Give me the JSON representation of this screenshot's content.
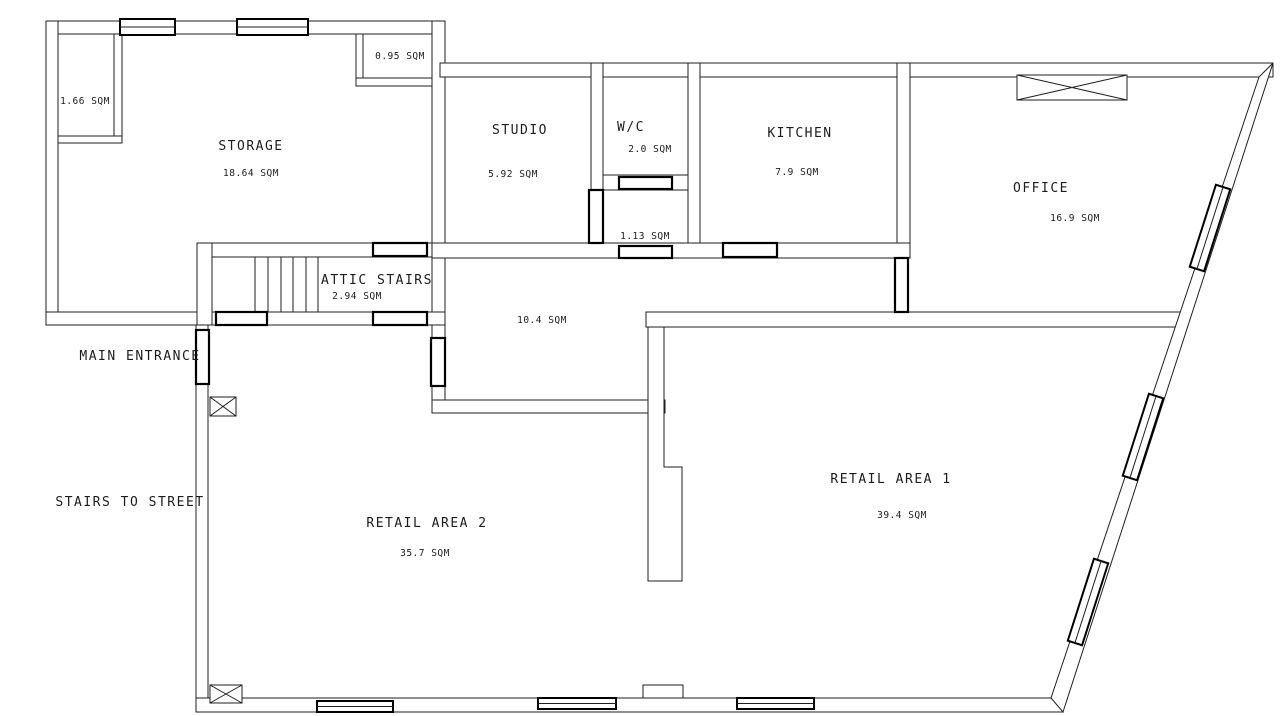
{
  "canvas": {
    "width": 1280,
    "height": 716,
    "background": "#ffffff",
    "line_color": "#1f1f1f"
  },
  "rooms": [
    {
      "id": "storage",
      "name": "STORAGE",
      "area": "18.64 SQM"
    },
    {
      "id": "studio",
      "name": "STUDIO",
      "area": "5.92 SQM"
    },
    {
      "id": "wc",
      "name": "W/C",
      "area": "2.0 SQM"
    },
    {
      "id": "kitchen",
      "name": "KITCHEN",
      "area": "7.9 SQM"
    },
    {
      "id": "office",
      "name": "OFFICE",
      "area": "16.9 SQM"
    },
    {
      "id": "attic-stairs",
      "name": "ATTIC STAIRS",
      "area": "2.94 SQM"
    },
    {
      "id": "retail-1",
      "name": "RETAIL AREA 1",
      "area": "39.4 SQM"
    },
    {
      "id": "retail-2",
      "name": "RETAIL AREA 2",
      "area": "35.7 SQM"
    }
  ],
  "spaces": [
    {
      "id": "closet",
      "area": "1.66 SQM"
    },
    {
      "id": "shaft",
      "area": "0.95 SQM"
    },
    {
      "id": "wc-lobby",
      "area": "1.13 SQM"
    },
    {
      "id": "corridor",
      "area": "10.4 SQM"
    }
  ],
  "annotations": [
    {
      "id": "main-entrance",
      "text": "MAIN ENTRANCE"
    },
    {
      "id": "stairs-to-street",
      "text": "STAIRS TO STREET"
    }
  ]
}
